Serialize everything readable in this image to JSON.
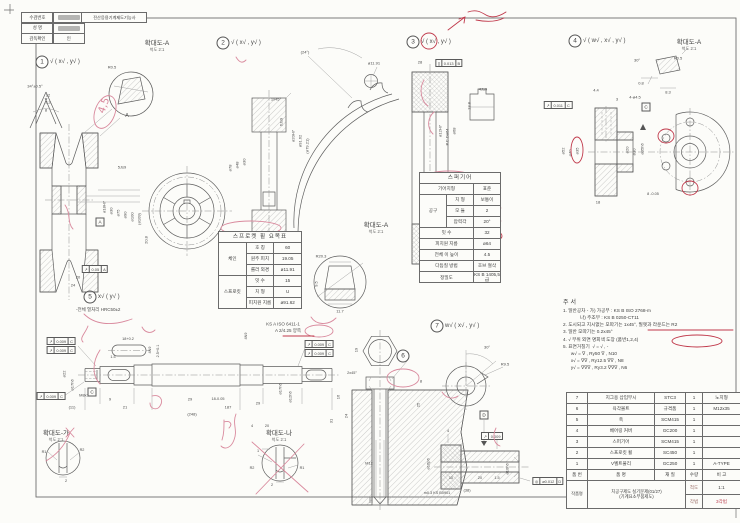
{
  "title_block": {
    "cert": "전산응용기계제도기능사",
    "fields": [
      {
        "label": "수검번호",
        "value": "",
        "redacted": true
      },
      {
        "label": "성  명",
        "value": "",
        "redacted": true
      },
      {
        "label": "감독확인",
        "value": "인",
        "redacted": false
      }
    ]
  },
  "balloons": [
    {
      "n": "1",
      "x": 42,
      "y": 62,
      "finish": "√ ( x√ , y√ )"
    },
    {
      "n": "2",
      "x": 223,
      "y": 43,
      "finish": "√ ( x√ , y√ )"
    },
    {
      "n": "3",
      "x": 413,
      "y": 42,
      "finish": "√ ( x√ , y√ )"
    },
    {
      "n": "4",
      "x": 575,
      "y": 41,
      "finish": "√ ( w√ , x√ , y√ )"
    },
    {
      "n": "5",
      "x": 90,
      "y": 297,
      "finish": "x√ ( y√ )",
      "note": "-전체 열처리 HRC50±2",
      "nx": 76,
      "ny": 307
    },
    {
      "n": "6",
      "x": 403,
      "y": 356,
      "finish": ""
    },
    {
      "n": "7",
      "x": 437,
      "y": 326,
      "finish": "w√ ( x√ , y√ )"
    }
  ],
  "details": [
    {
      "x": 157,
      "y": 37,
      "title": "확대도-A",
      "scale": "척도 2:1"
    },
    {
      "x": 376,
      "y": 219,
      "title": "확대도-A",
      "scale": "척도 2:1"
    },
    {
      "x": 689,
      "y": 36,
      "title": "확대도-A",
      "scale": "척도 2:1"
    },
    {
      "x": 56,
      "y": 427,
      "title": "확대도-가",
      "scale": "척도 2:1"
    },
    {
      "x": 279,
      "y": 427,
      "title": "확대도-나",
      "scale": "척도 2:1"
    }
  ],
  "sprocket_table": {
    "title": "스프로켓 휠 요목표",
    "rows": [
      {
        "g": "체인",
        "n": 3,
        "l": "호 칭",
        "v": "60"
      },
      {
        "l": "원주 피치",
        "v": "19.05"
      },
      {
        "l": "롤러 외경",
        "v": "ø11.91"
      },
      {
        "g": "스프로킷",
        "n": 3,
        "l": "잇 수",
        "v": "15"
      },
      {
        "l": "치 형",
        "v": "U"
      },
      {
        "l": "피치원 지름",
        "v": "ø91.62"
      }
    ]
  },
  "gear_table": {
    "title": "스퍼기어",
    "rows": [
      {
        "l": "기어치형",
        "v": "표준",
        "w": 1
      },
      {
        "g": "공구",
        "n": 3,
        "l": "치 형",
        "v": "보통이"
      },
      {
        "l": "모 듈",
        "v": "2"
      },
      {
        "l": "압력각",
        "v": "20°"
      },
      {
        "l": "잇 수",
        "v": "32",
        "w": 1
      },
      {
        "l": "피치원 지름",
        "v": "ø64",
        "w": 1
      },
      {
        "l": "전체 이 높이",
        "v": "4.5",
        "w": 1
      },
      {
        "l": "다듬질 방법",
        "v": "호브 절삭",
        "w": 1
      },
      {
        "l": "정밀도",
        "v": "KS B 1405,5급",
        "w": 1
      }
    ]
  },
  "notes": {
    "title": "주서",
    "lines": [
      "1. 일반공차 - 가) 가공부 : KS B ISO 2768-m",
      "             나) 주조부 : KS B 0250-CT11",
      "2. 도시되고 지시없는 모따기는 1x45°, 필렛과 라운드는 R2",
      "3. 일반 모따기는 0.2x45°",
      "4. √ 부위 외면 명회색 도장 (품번1,2,4)",
      "5. 표면거칠기  √ = √ , -",
      "      w√ = ∇ , Ry50 ∇ , N10",
      "      x√ = ∇∇ , Ry12.5 ∇∇ , N8",
      "      y√ = ∇∇∇ , Ry3.2 ∇∇∇ , N6"
    ]
  },
  "parts_list": {
    "headers": [
      "품 번",
      "품   명",
      "재 질",
      "수량",
      "비 고"
    ],
    "rows": [
      [
        "7",
        "지그용 삽입부시",
        "STC3",
        "1",
        "노치형"
      ],
      [
        "6",
        "육각볼트",
        "규격품",
        "1",
        "M12x35"
      ],
      [
        "5",
        "축",
        "SCM415",
        "1",
        ""
      ],
      [
        "4",
        "베어링 커버",
        "GC200",
        "1",
        ""
      ],
      [
        "3",
        "스퍼기어",
        "SCM415",
        "1",
        ""
      ],
      [
        "2",
        "스프로킷 휠",
        "SC450",
        "1",
        ""
      ],
      [
        "1",
        "V벨트풀리",
        "GC250",
        "1",
        "A-TYPE"
      ]
    ],
    "footer": {
      "label": "작품명",
      "line1": "치공구제도 실기문제(01/27)",
      "line2": "(기계요소부품제도)",
      "scale_label": "척도",
      "scale": "1:1",
      "method_label": "각법",
      "method": "3각법"
    }
  },
  "dims": [
    {
      "x": 35,
      "y": 86,
      "t": "34°±0.5°"
    },
    {
      "x": 48,
      "y": 95,
      "t": "12"
    },
    {
      "x": 48,
      "y": 102,
      "t": "3.2"
    },
    {
      "x": 46,
      "y": 110,
      "t": "8"
    },
    {
      "x": 127,
      "y": 116,
      "t": "A",
      "f": 5
    },
    {
      "x": 112,
      "y": 67,
      "t": "R0.5"
    },
    {
      "x": 104,
      "y": 207,
      "t": "ø18H7",
      "r": -90
    },
    {
      "x": 111,
      "y": 211,
      "t": "ø30",
      "r": -90
    },
    {
      "x": 118,
      "y": 213,
      "t": "ø75",
      "r": -90
    },
    {
      "x": 125,
      "y": 215,
      "t": "ø90",
      "r": -90
    },
    {
      "x": 132,
      "y": 217,
      "t": "ø100",
      "r": -90
    },
    {
      "x": 139,
      "y": 219,
      "t": "(ø109)",
      "r": -90
    },
    {
      "x": 122,
      "y": 167,
      "t": "5Js9"
    },
    {
      "x": 146,
      "y": 240,
      "t": "20.8",
      "r": -90
    },
    {
      "x": 78,
      "y": 277,
      "t": "20"
    },
    {
      "x": 73,
      "y": 285,
      "t": "24"
    },
    {
      "x": 283,
      "y": 324,
      "t": "KS A ISO 6411-1",
      "f": 4.5
    },
    {
      "x": 288,
      "y": 331,
      "t": "A 2/4.25 양쪽",
      "f": 4.5
    },
    {
      "x": 305,
      "y": 52,
      "t": "(24°)"
    },
    {
      "x": 374,
      "y": 63,
      "t": "ø11.91"
    },
    {
      "x": 276,
      "y": 99,
      "t": "1x45°"
    },
    {
      "x": 281,
      "y": 122,
      "t": "6Js9",
      "r": -90
    },
    {
      "x": 244,
      "y": 162,
      "t": "ø30",
      "r": -90
    },
    {
      "x": 237,
      "y": 165,
      "t": "ø48",
      "r": -90
    },
    {
      "x": 230,
      "y": 168,
      "t": "ø78",
      "r": -90
    },
    {
      "x": 293,
      "y": 136,
      "t": "ø20H7",
      "r": -90
    },
    {
      "x": 300,
      "y": 141,
      "t": "ø91.62",
      "r": -90
    },
    {
      "x": 307,
      "y": 146,
      "t": "(ø79.21)",
      "r": -90
    },
    {
      "x": 250,
      "y": 268,
      "t": "10"
    },
    {
      "x": 250,
      "y": 276,
      "t": "16"
    },
    {
      "x": 321,
      "y": 256,
      "t": "R20.3"
    },
    {
      "x": 316,
      "y": 284,
      "t": "9.5",
      "r": -90
    },
    {
      "x": 340,
      "y": 311,
      "t": "11.7"
    },
    {
      "x": 420,
      "y": 62,
      "t": "28"
    },
    {
      "x": 440,
      "y": 131,
      "t": "ø12H7",
      "r": -90
    },
    {
      "x": 447,
      "y": 137,
      "t": "P.C.Dø64",
      "r": -90
    },
    {
      "x": 454,
      "y": 131,
      "t": "ø68",
      "r": -90
    },
    {
      "x": 483,
      "y": 89,
      "t": "4Js9"
    },
    {
      "x": 469,
      "y": 106,
      "t": "13.8",
      "r": -90
    },
    {
      "x": 596,
      "y": 90,
      "t": "4.4"
    },
    {
      "x": 617,
      "y": 99,
      "t": "3"
    },
    {
      "x": 635,
      "y": 97,
      "t": "4-ø4.5"
    },
    {
      "x": 563,
      "y": 151,
      "t": "ø52",
      "r": -90
    },
    {
      "x": 570,
      "y": 153,
      "t": "ø40",
      "r": -90
    },
    {
      "x": 577,
      "y": 151,
      "t": "ø35",
      "r": -90
    },
    {
      "x": 627,
      "y": 150,
      "t": "ø20",
      "r": -90
    },
    {
      "x": 634,
      "y": 152,
      "t": "ø30",
      "r": -90
    },
    {
      "x": 642,
      "y": 149,
      "t": "ø35h6",
      "r": -90
    },
    {
      "x": 653,
      "y": 194,
      "t": "8 -0.05",
      "f": 3.8
    },
    {
      "x": 598,
      "y": 202,
      "t": "18"
    },
    {
      "x": 637,
      "y": 60,
      "t": "30°"
    },
    {
      "x": 678,
      "y": 58,
      "t": "R0.5"
    },
    {
      "x": 641,
      "y": 83,
      "t": "0.8"
    },
    {
      "x": 668,
      "y": 92,
      "t": "8.3"
    },
    {
      "x": 64,
      "y": 374,
      "t": "ø22",
      "r": -90
    },
    {
      "x": 72,
      "y": 385,
      "t": "ø17h6",
      "r": -90
    },
    {
      "x": 84,
      "y": 395,
      "t": "M8x1"
    },
    {
      "x": 128,
      "y": 339,
      "t": "18+0.2",
      "f": 3.8
    },
    {
      "x": 150,
      "y": 350,
      "t": "4N9",
      "r": -90,
      "f": 3.8
    },
    {
      "x": 158,
      "y": 351,
      "t": "2.5+0.1",
      "r": -90,
      "f": 3.8
    },
    {
      "x": 113,
      "y": 357,
      "t": "1.5",
      "f": 3.8
    },
    {
      "x": 110,
      "y": 399,
      "t": "9"
    },
    {
      "x": 190,
      "y": 399,
      "t": "29"
    },
    {
      "x": 218,
      "y": 399,
      "t": "18-0.05",
      "f": 3.8
    },
    {
      "x": 72,
      "y": 407,
      "t": "(11)"
    },
    {
      "x": 125,
      "y": 407,
      "t": "21"
    },
    {
      "x": 228,
      "y": 407,
      "t": "187"
    },
    {
      "x": 192,
      "y": 414,
      "t": "(248)"
    },
    {
      "x": 246,
      "y": 336,
      "t": "4N9",
      "r": -90,
      "f": 3.8
    },
    {
      "x": 280,
      "y": 389,
      "t": "ø17h6",
      "r": -90
    },
    {
      "x": 290,
      "y": 397,
      "t": "ø12h6",
      "r": -90
    },
    {
      "x": 258,
      "y": 403,
      "t": "29"
    },
    {
      "x": 252,
      "y": 426,
      "t": "4",
      "f": 3.8
    },
    {
      "x": 267,
      "y": 426,
      "t": "20",
      "f": 3.8
    },
    {
      "x": 356,
      "y": 350,
      "t": "19",
      "r": -90
    },
    {
      "x": 352,
      "y": 373,
      "t": "2x45°",
      "f": 3.8
    },
    {
      "x": 338,
      "y": 397,
      "t": "16",
      "r": -90
    },
    {
      "x": 346,
      "y": 416,
      "t": "24",
      "r": -90
    },
    {
      "x": 331,
      "y": 421,
      "t": "31",
      "r": -90
    },
    {
      "x": 421,
      "y": 381,
      "t": "8"
    },
    {
      "x": 418,
      "y": 405,
      "t": "25",
      "r": -90
    },
    {
      "x": 369,
      "y": 463,
      "t": "M12"
    },
    {
      "x": 487,
      "y": 347,
      "t": "30°"
    },
    {
      "x": 505,
      "y": 364,
      "t": "R9.5"
    },
    {
      "x": 448,
      "y": 431,
      "t": "4",
      "f": 3.8
    },
    {
      "x": 451,
      "y": 478,
      "t": "10",
      "f": 3.8
    },
    {
      "x": 480,
      "y": 478,
      "t": "20",
      "f": 3.8
    },
    {
      "x": 497,
      "y": 478,
      "t": "1.5",
      "f": 3.8
    },
    {
      "x": 467,
      "y": 490,
      "t": "(38)"
    },
    {
      "x": 507,
      "y": 469,
      "t": "ø10h6",
      "r": -90
    },
    {
      "x": 428,
      "y": 464,
      "t": "ø16p6",
      "r": -90
    },
    {
      "x": 437,
      "y": 493,
      "t": "m0.3 KS B0901",
      "f": 3.8
    },
    {
      "x": 44,
      "y": 452,
      "t": "R1",
      "f": 3.8
    },
    {
      "x": 82,
      "y": 450,
      "t": "R2",
      "f": 3.8
    },
    {
      "x": 66,
      "y": 481,
      "t": "2",
      "f": 3.8
    },
    {
      "x": 258,
      "y": 451,
      "t": "1",
      "f": 3.8
    },
    {
      "x": 252,
      "y": 468,
      "t": "R2",
      "f": 3.8
    },
    {
      "x": 302,
      "y": 468,
      "t": "R1",
      "f": 3.8
    },
    {
      "x": 272,
      "y": 485,
      "t": "2",
      "f": 3.8
    }
  ],
  "gdt": [
    {
      "x": 95,
      "y": 269,
      "s": "↗",
      "v": "0.05",
      "d": "A"
    },
    {
      "x": 449,
      "y": 63,
      "s": "∥",
      "v": "0.013",
      "d": "B"
    },
    {
      "x": 558,
      "y": 105,
      "s": "↗",
      "v": "0.011",
      "d": "C"
    },
    {
      "x": 61,
      "y": 341,
      "s": "↗",
      "v": "0.009",
      "d": "C"
    },
    {
      "x": 61,
      "y": 350,
      "s": "↗",
      "v": "0.009",
      "d": "C"
    },
    {
      "x": 51,
      "y": 396,
      "s": "↗",
      "v": "0.009",
      "d": "C"
    },
    {
      "x": 319,
      "y": 344,
      "s": "↗",
      "v": "0.009",
      "d": "C"
    },
    {
      "x": 319,
      "y": 353,
      "s": "↗",
      "v": "0.009",
      "d": "C"
    },
    {
      "x": 492,
      "y": 436,
      "s": "↗",
      "v": "0.009",
      "d": ""
    },
    {
      "x": 548,
      "y": 481,
      "s": "◎",
      "v": "ø0.012",
      "d": "D"
    }
  ],
  "datums": [
    {
      "x": 100,
      "y": 222,
      "t": "A"
    },
    {
      "x": 646,
      "y": 107,
      "t": "C"
    },
    {
      "x": 92,
      "y": 392,
      "t": "C"
    },
    {
      "x": 484,
      "y": 415,
      "t": "D"
    },
    {
      "x": 429,
      "y": 271,
      "t": "B"
    }
  ],
  "red_annotations": [
    {
      "t": "x",
      "x": 104,
      "y": 114,
      "s": "4,5",
      "fs": 10,
      "r": -70,
      "c": "p"
    },
    {
      "t": "e",
      "x": 105,
      "y": 112,
      "rx": 10,
      "ry": 17,
      "r": 20,
      "c": "p"
    },
    {
      "t": "p",
      "d": "M65,205 c6,8 2,18 8,24",
      "c": "p"
    },
    {
      "t": "p",
      "d": "M84,314 c10,10 26,13 48,5",
      "c": "p"
    },
    {
      "t": "p",
      "d": "M88,326 c-3,8 -9,12 -5,16",
      "c": "p"
    },
    {
      "t": "p",
      "d": "M142,327 c3,6 9,7 13,3",
      "c": "p"
    },
    {
      "t": "e",
      "x": 251,
      "y": 228,
      "rx": 30,
      "ry": 7,
      "c": "p"
    },
    {
      "t": "l",
      "x1": 246,
      "y1": 251,
      "x2": 264,
      "y2": 255
    },
    {
      "t": "p",
      "d": "M336,318 c-8,8 -20,7 -25,-1",
      "c": "p"
    },
    {
      "t": "p",
      "d": "M448,30 l17,-13 m-6,2 l6,-2 l-1,6"
    },
    {
      "t": "p",
      "d": "M468,12 c8,-3 13,0 18,3 c7,4 14,1 20,-3 m-30,8 c10,2 20,2 28,-2"
    },
    {
      "t": "e",
      "x": 429,
      "y": 41,
      "rx": 8,
      "ry": 8
    },
    {
      "t": "p",
      "d": "M424,80 c-6,10 -2,22 4,26",
      "c": "p"
    },
    {
      "t": "p",
      "d": "M434,112 c-7,6 -7,16 -1,22",
      "c": "p"
    },
    {
      "t": "e",
      "x": 449,
      "y": 178,
      "rx": 25,
      "ry": 7,
      "c": "p"
    },
    {
      "t": "p",
      "d": "M488,209 c4,4 9,4 13,-1",
      "c": "p"
    },
    {
      "t": "p",
      "d": "M486,221 c4,6 10,6 15,0",
      "c": "p"
    },
    {
      "t": "e",
      "x": 489,
      "y": 236,
      "rx": 13,
      "ry": 6
    },
    {
      "t": "e",
      "x": 489,
      "y": 249,
      "rx": 11,
      "ry": 6
    },
    {
      "t": "e",
      "x": 577,
      "y": 150,
      "rx": 6,
      "ry": 13
    },
    {
      "t": "e",
      "x": 666,
      "y": 136,
      "rx": 8,
      "ry": 7
    },
    {
      "t": "e",
      "x": 690,
      "y": 188,
      "rx": 8,
      "ry": 7
    },
    {
      "t": "l",
      "x1": 648,
      "y1": 330,
      "x2": 733,
      "y2": 330
    },
    {
      "t": "e",
      "x": 697,
      "y": 341,
      "rx": 25,
      "ry": 6
    },
    {
      "t": "e",
      "x": 670,
      "y": 420,
      "rx": 21,
      "ry": 5
    },
    {
      "t": "e",
      "x": 670,
      "y": 431,
      "rx": 21,
      "ry": 5
    },
    {
      "t": "e",
      "x": 670,
      "y": 442,
      "rx": 21,
      "ry": 5
    },
    {
      "t": "p",
      "d": "M100,350 c-8,12 -8,26 0,34",
      "c": "p"
    },
    {
      "t": "p",
      "d": "M152,396 c8,-2 12,4 8,10 c-3,5 -10,3 -10,-3",
      "c": "p"
    },
    {
      "t": "p",
      "d": "M236,414 c-4,10 2,16 -2,26 c-3,8 -9,10 -13,6",
      "c": "p"
    },
    {
      "t": "p",
      "d": "M224,420 c0,8 0,14 -2,20 m2,-18 c6,-2 9,2 5,6",
      "c": "p"
    },
    {
      "t": "l",
      "x1": 252,
      "y1": 442,
      "x2": 308,
      "y2": 492,
      "c": "p"
    },
    {
      "t": "l",
      "x1": 304,
      "y1": 444,
      "x2": 256,
      "y2": 494,
      "c": "p"
    },
    {
      "t": "p",
      "d": "M66,428 l8,9 m0,-9 l-8,9",
      "c": "p"
    },
    {
      "t": "p",
      "d": "M70,433 c-6,14 -14,22 -24,28",
      "c": "p"
    },
    {
      "t": "e",
      "x": 403,
      "y": 378,
      "rx": 16,
      "ry": 9,
      "c": "p"
    },
    {
      "t": "p",
      "d": "M442,392 c4,6 10,8 16,4",
      "c": "p"
    },
    {
      "t": "p",
      "d": "M496,428 c-4,8 -2,16 4,18",
      "c": "p"
    },
    {
      "t": "e",
      "x": 319,
      "y": 331,
      "rx": 14,
      "ry": 6,
      "c": "p"
    },
    {
      "t": "l",
      "x1": 283,
      "y1": 336,
      "x2": 314,
      "y2": 336
    },
    {
      "t": "p",
      "d": "M236,57 c3,5 6,7 10,3",
      "c": "p"
    }
  ],
  "colors": {
    "red": "#c0394b",
    "pink": "#d9899d",
    "line": "#5e5e5e"
  }
}
